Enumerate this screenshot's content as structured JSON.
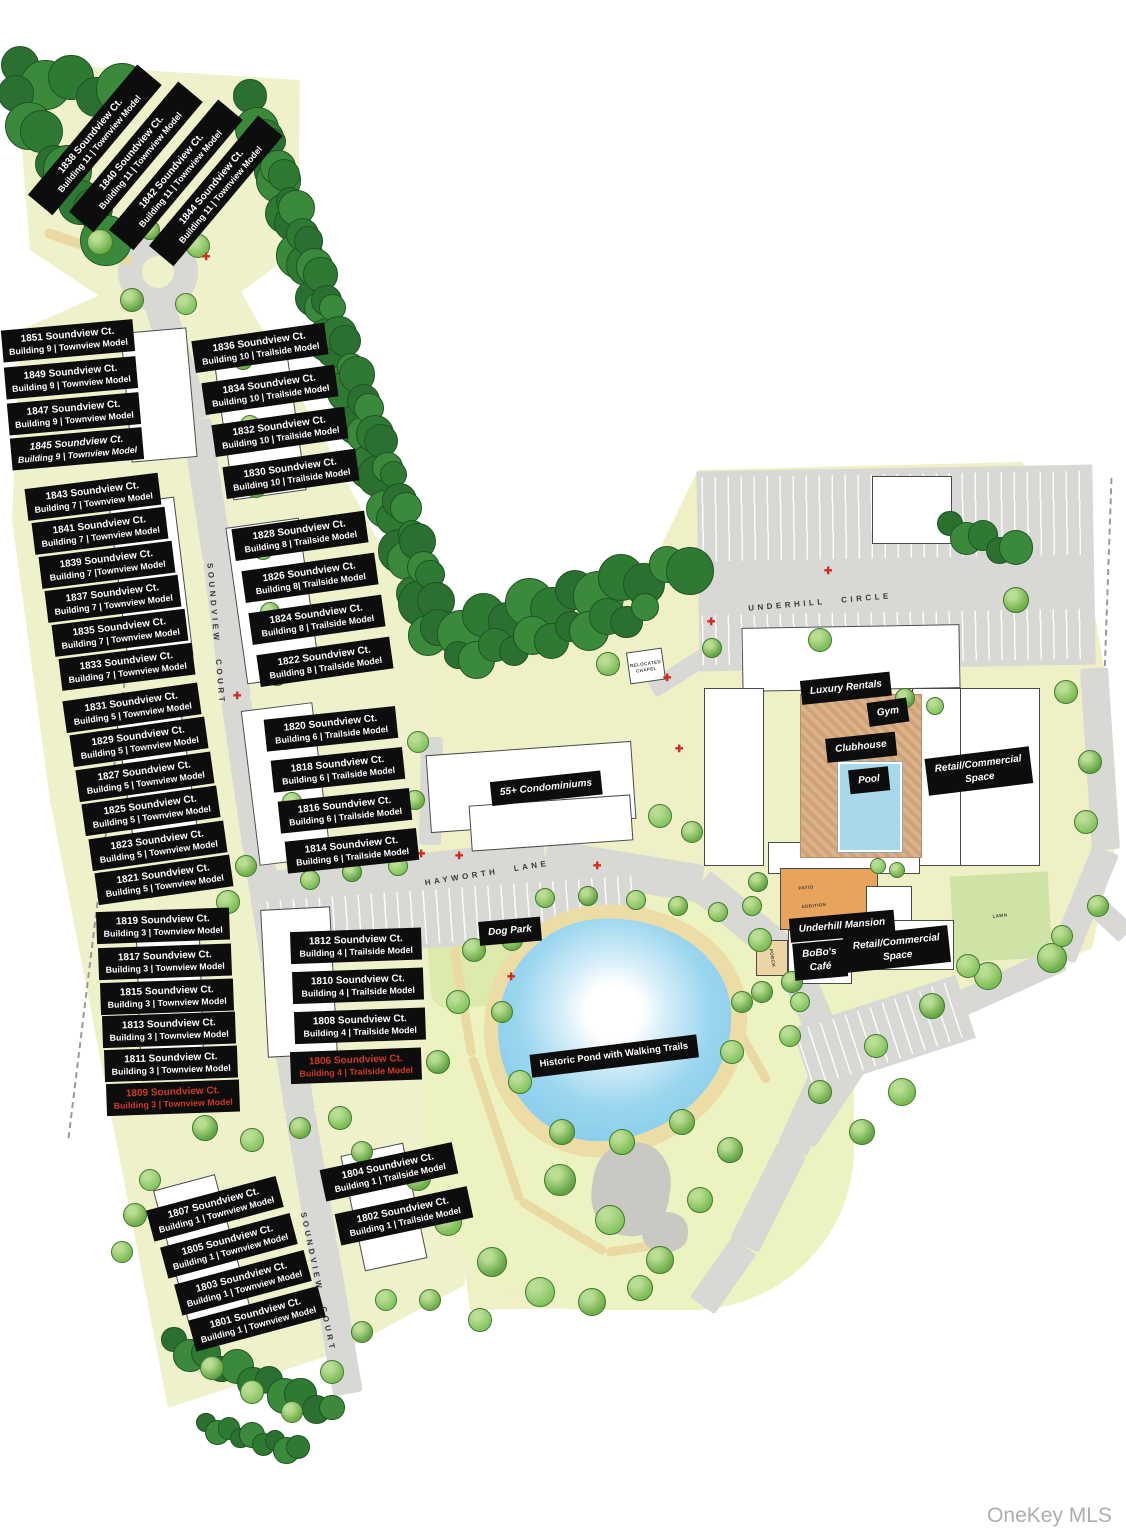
{
  "watermark": "OneKey MLS",
  "colors": {
    "label_bg": "#0d0d0d",
    "label_text": "#ffffff",
    "highlight_text": "#cf3a28",
    "land": "#eff1cb",
    "road": "#d8d8d5",
    "pond": "#8ecfec",
    "tree": "#6fae49",
    "dark_tree": "#2e7a33",
    "mansion": "#e8a35c",
    "pool": "#a8d8ea"
  },
  "streets": [
    {
      "name": "UNDERHILL CIRCLE",
      "x": 820,
      "y": 602,
      "rot": -5
    },
    {
      "name": "HAYWORTH LANE",
      "x": 487,
      "y": 873,
      "rot": -9
    },
    {
      "name": "SOUNDVIEW COURT",
      "x": 216,
      "y": 634,
      "rot": 85
    },
    {
      "name": "SOUNDVIEW COURT",
      "x": 318,
      "y": 1282,
      "rot": 78
    }
  ],
  "area_labels": [
    {
      "text": "Luxury Rentals",
      "x": 846,
      "y": 688,
      "rot": -6,
      "italic": true
    },
    {
      "text": "Gym",
      "x": 888,
      "y": 712,
      "rot": -8,
      "italic": true
    },
    {
      "text": "Clubhouse",
      "x": 861,
      "y": 747,
      "rot": -6,
      "italic": true
    },
    {
      "text": "Pool",
      "x": 869,
      "y": 780,
      "rot": -6,
      "italic": true
    },
    {
      "lines": [
        "Retail/Commercial",
        "Space"
      ],
      "x": 979,
      "y": 771,
      "rot": -7,
      "italic": true
    },
    {
      "text": "Underhill Mansion",
      "x": 842,
      "y": 926,
      "rot": -5,
      "italic": true
    },
    {
      "lines": [
        "BoBo's",
        "Café"
      ],
      "x": 820,
      "y": 960,
      "rot": -5,
      "italic": true
    },
    {
      "lines": [
        "Retail/Commercial",
        "Space"
      ],
      "x": 897,
      "y": 949,
      "rot": -6,
      "italic": true
    },
    {
      "text": "55+ Condominiums",
      "x": 546,
      "y": 788,
      "rot": -6,
      "italic": true
    },
    {
      "text": "Dog Park",
      "x": 510,
      "y": 931,
      "rot": -5,
      "italic": true
    },
    {
      "text": "Historic Pond with Walking Trails",
      "x": 614,
      "y": 1056,
      "rot": -7,
      "italic": false,
      "small": true
    }
  ],
  "micro_labels": [
    {
      "lines": [
        "RELOCATED",
        "CHAPEL"
      ],
      "x": 646,
      "y": 667,
      "rot": -8
    },
    {
      "text": "LAWN",
      "x": 1000,
      "y": 916,
      "rot": -5
    },
    {
      "text": "PORCH",
      "x": 772,
      "y": 958,
      "rot": 80
    },
    {
      "text": "PATIO",
      "x": 806,
      "y": 888,
      "rot": -5
    },
    {
      "text": "ADDITION",
      "x": 814,
      "y": 906,
      "rot": -5
    }
  ],
  "unit_labels": [
    {
      "address": "1838 Soundview Ct.",
      "building": "Building 11 | Townview Model",
      "x": 95,
      "y": 140,
      "w": 170,
      "rot": -50
    },
    {
      "address": "1840 Soundview Ct.",
      "building": "Building 11 | Townview Model",
      "x": 136,
      "y": 157,
      "w": 170,
      "rot": -50
    },
    {
      "address": "1842 Soundview Ct.",
      "building": "Building 11 | Townview Model",
      "x": 176,
      "y": 175,
      "w": 170,
      "rot": -50
    },
    {
      "address": "1844 Soundview Ct.",
      "building": "Building 11 | Townview Model",
      "x": 216,
      "y": 191,
      "w": 170,
      "rot": -50
    },
    {
      "address": "1851 Soundview Ct.",
      "building": "Building 9 | Townview Model",
      "x": 68,
      "y": 341,
      "w": 132,
      "rot": -5
    },
    {
      "address": "1849 Soundview Ct.",
      "building": "Building 9 | Townview Model",
      "x": 71,
      "y": 378,
      "w": 132,
      "rot": -5
    },
    {
      "address": "1847 Soundview Ct.",
      "building": "Building 9 | Townview Model",
      "x": 74,
      "y": 414,
      "w": 132,
      "rot": -5
    },
    {
      "address": "1845 Soundview Ct.",
      "building": "Building 9 | Townview Model",
      "x": 77,
      "y": 449,
      "w": 132,
      "rot": -5,
      "italic": true
    },
    {
      "address": "1843 Soundview Ct.",
      "building": "Building 7 | Townview Model",
      "x": 93,
      "y": 497,
      "w": 134,
      "rot": -7
    },
    {
      "address": "1841 Soundview Ct.",
      "building": "Building 7 | Townview Model",
      "x": 100,
      "y": 531,
      "w": 134,
      "rot": -7
    },
    {
      "address": "1839 Soundview Ct.",
      "building": "Building 7 |Townview Model",
      "x": 107,
      "y": 565,
      "w": 134,
      "rot": -7
    },
    {
      "address": "1837 Soundview Ct.",
      "building": "Building 7 | Townview Model",
      "x": 113,
      "y": 599,
      "w": 134,
      "rot": -7
    },
    {
      "address": "1835 Soundview Ct.",
      "building": "Building 7 | Townview Model",
      "x": 120,
      "y": 633,
      "w": 134,
      "rot": -7
    },
    {
      "address": "1833 Soundview Ct.",
      "building": "Building 7 | Townview Model",
      "x": 127,
      "y": 667,
      "w": 134,
      "rot": -7
    },
    {
      "address": "1831 Soundview Ct.",
      "building": "Building 5 | Townview Model",
      "x": 132,
      "y": 708,
      "w": 136,
      "rot": -8
    },
    {
      "address": "1829 Soundview Ct.",
      "building": "Building 5 | Townview Model",
      "x": 139,
      "y": 742,
      "w": 136,
      "rot": -8
    },
    {
      "address": "1827 Soundview Ct.",
      "building": "Building 5 | Townview Model",
      "x": 145,
      "y": 777,
      "w": 136,
      "rot": -8
    },
    {
      "address": "1825 Soundview Ct.",
      "building": "Building 5 | Townview Model",
      "x": 151,
      "y": 811,
      "w": 136,
      "rot": -8
    },
    {
      "address": "1823 Soundview Ct.",
      "building": "Building 5 | Townview Model",
      "x": 158,
      "y": 846,
      "w": 136,
      "rot": -8
    },
    {
      "address": "1821 Soundview Ct.",
      "building": "Building 5 | Townview Model",
      "x": 164,
      "y": 880,
      "w": 136,
      "rot": -8
    },
    {
      "address": "1819 Soundview Ct.",
      "building": "Building 3 | Townview Model",
      "x": 163,
      "y": 926,
      "w": 133,
      "rot": -2
    },
    {
      "address": "1817 Soundview Ct.",
      "building": "Building 3 | Townview Model",
      "x": 165,
      "y": 962,
      "w": 133,
      "rot": -2
    },
    {
      "address": "1815 Soundview Ct.",
      "building": "Building 3 | Townview Model",
      "x": 167,
      "y": 997,
      "w": 133,
      "rot": -2
    },
    {
      "address": "1813 Soundview Ct.",
      "building": "Building 3 | Townview Model",
      "x": 169,
      "y": 1030,
      "w": 133,
      "rot": -2
    },
    {
      "address": "1811 Soundview Ct.",
      "building": "Building 3 | Townview Model",
      "x": 171,
      "y": 1064,
      "w": 133,
      "rot": -2
    },
    {
      "address": "1809 Soundview Ct.",
      "building": "Building 3 | Townview Model",
      "x": 173,
      "y": 1098,
      "w": 133,
      "rot": -2,
      "red": true
    },
    {
      "address": "1807 Soundview Ct.",
      "building": "Building 1 | Townview Model",
      "x": 215,
      "y": 1209,
      "w": 134,
      "rot": -15
    },
    {
      "address": "1805 Soundview Ct.",
      "building": "Building 1 | Townview Model",
      "x": 229,
      "y": 1246,
      "w": 134,
      "rot": -15
    },
    {
      "address": "1803 Soundview Ct.",
      "building": "Building 1 | Townview Model",
      "x": 243,
      "y": 1283,
      "w": 134,
      "rot": -15
    },
    {
      "address": "1801 Soundview Ct.",
      "building": "Building 1 | Townview Model",
      "x": 257,
      "y": 1319,
      "w": 134,
      "rot": -15
    },
    {
      "address": "1836 Soundview Ct.",
      "building": "Building 10 | Trailside Model",
      "x": 260,
      "y": 348,
      "w": 134,
      "rot": -8
    },
    {
      "address": "1834 Soundview Ct.",
      "building": "Building 10 | Trailside Model",
      "x": 270,
      "y": 390,
      "w": 134,
      "rot": -8
    },
    {
      "address": "1832 Soundview Ct.",
      "building": "Building 10 | Trailside Model",
      "x": 280,
      "y": 432,
      "w": 134,
      "rot": -8
    },
    {
      "address": "1830 Soundview Ct.",
      "building": "Building 10 | Trailside Model",
      "x": 291,
      "y": 474,
      "w": 134,
      "rot": -8
    },
    {
      "address": "1828 Soundview Ct.",
      "building": "Building 8 | Trailside Model",
      "x": 300,
      "y": 536,
      "w": 134,
      "rot": -8
    },
    {
      "address": "1826 Soundview Ct.",
      "building": "Building 8| Trailside Model",
      "x": 310,
      "y": 578,
      "w": 134,
      "rot": -8
    },
    {
      "address": "1824 Soundview Ct.",
      "building": "Building 8 | Trailside Model",
      "x": 317,
      "y": 620,
      "w": 134,
      "rot": -8
    },
    {
      "address": "1822 Soundview Ct.",
      "building": "Building 8 | Trailside Model",
      "x": 325,
      "y": 662,
      "w": 134,
      "rot": -8
    },
    {
      "address": "1820 Soundview Ct.",
      "building": "Building 6 | Trailside Model",
      "x": 331,
      "y": 729,
      "w": 132,
      "rot": -6
    },
    {
      "address": "1818 Soundview Ct.",
      "building": "Building 6 | Trailside Model",
      "x": 338,
      "y": 770,
      "w": 132,
      "rot": -6
    },
    {
      "address": "1816 Soundview Ct.",
      "building": "Building 6 | Trailside Model",
      "x": 345,
      "y": 811,
      "w": 132,
      "rot": -6
    },
    {
      "address": "1814 Soundview Ct.",
      "building": "Building 6 | Trailside Model",
      "x": 352,
      "y": 851,
      "w": 132,
      "rot": -6
    },
    {
      "address": "1812 Soundview Ct.",
      "building": "Building 4 | Trailside Model",
      "x": 356,
      "y": 946,
      "w": 131,
      "rot": -2
    },
    {
      "address": "1810 Soundview Ct.",
      "building": "Building 4 | Trailside Model",
      "x": 358,
      "y": 986,
      "w": 131,
      "rot": -2
    },
    {
      "address": "1808 Soundview Ct.",
      "building": "Building 4 | Trailside Model",
      "x": 360,
      "y": 1026,
      "w": 131,
      "rot": -2
    },
    {
      "address": "1806 Soundview Ct.",
      "building": "Building 4 | Trailside Model",
      "x": 356,
      "y": 1066,
      "w": 131,
      "rot": -2,
      "red": true
    },
    {
      "address": "1804 Soundview Ct.",
      "building": "Building 1 | Trailside Model",
      "x": 389,
      "y": 1172,
      "w": 135,
      "rot": -12
    },
    {
      "address": "1802 Soundview Ct.",
      "building": "Building 1 | Trailside Model",
      "x": 404,
      "y": 1216,
      "w": 135,
      "rot": -12
    }
  ]
}
